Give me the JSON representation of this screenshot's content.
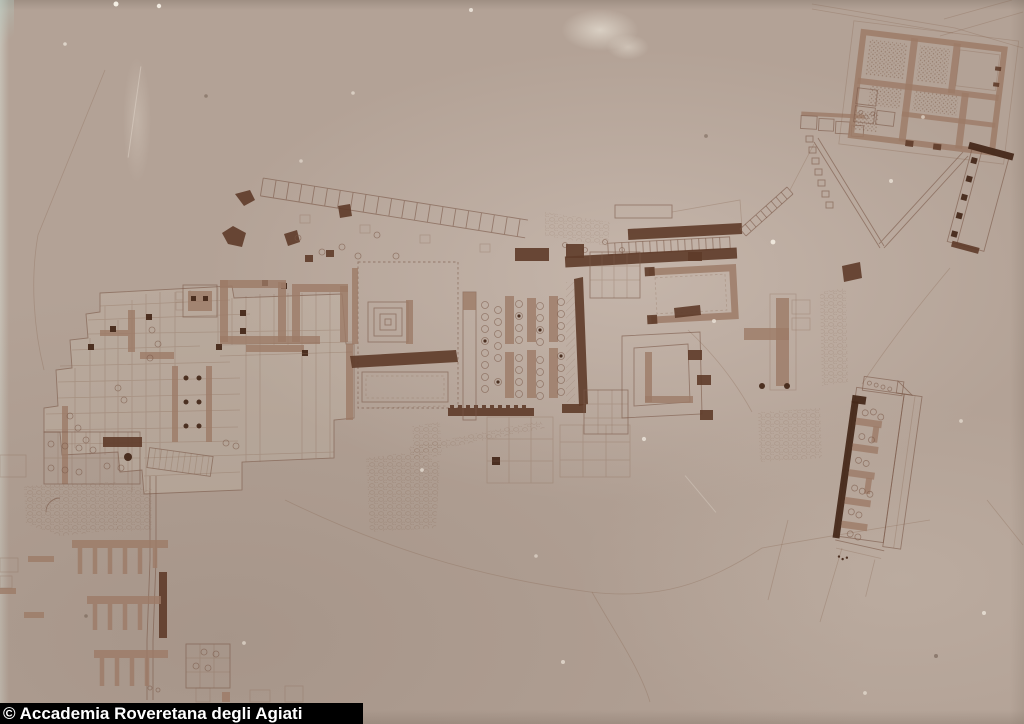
{
  "caption": {
    "text": "© Accademia Roveretana degli Agiati"
  },
  "photo": {
    "colors": {
      "paper_light": "#c6b5a8",
      "paper_mid": "#b3a296",
      "paper_dark": "#998a7e",
      "ink_line": "#7a5948",
      "ink_faint": "#8a6a55",
      "wall_medium": "#9c7b67",
      "wall_dark": "#5e3b29",
      "wall_darkest": "#46291a",
      "caption_bg": "#000000",
      "caption_text": "#ffffff"
    }
  }
}
